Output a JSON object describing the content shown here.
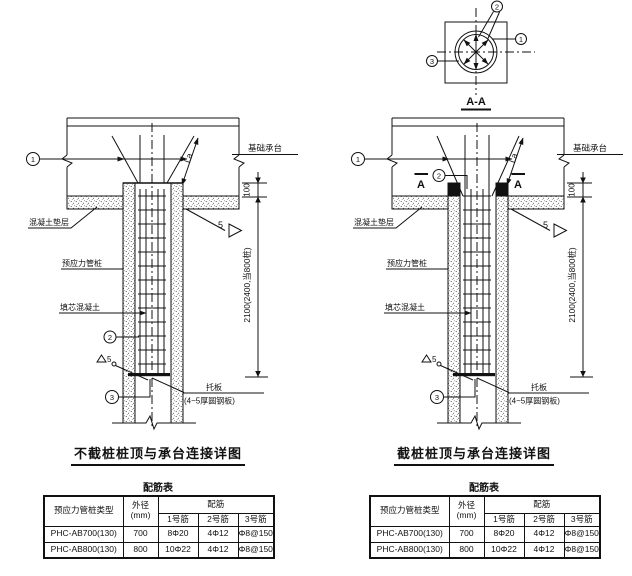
{
  "labels": {
    "foundation_cap": "基础承台",
    "concrete_cushion": "混凝土垫层",
    "prestressed_pipe_pile": "预应力管桩",
    "core_filling_concrete": "填芯混凝土",
    "bearing_plate": "托板",
    "bearing_plate_note": "(4~5厚圆钢板)",
    "anchorage_length": "La",
    "weld_size": "5",
    "embed_depth": "100",
    "pile_fill_depth": "2100(2400,当800桩)"
  },
  "callouts": {
    "n1": "1",
    "n2": "2",
    "n3": "3"
  },
  "left_figure": {
    "title": "不截桩桩顶与承台连接详图"
  },
  "right_figure": {
    "title": "截桩桩顶与承台连接详图",
    "section_title": "A-A",
    "section_mark": "A"
  },
  "rebar_table": {
    "title": "配筋表",
    "header": {
      "pile_type": "预应力管桩类型",
      "outer_diameter_line1": "外径",
      "outer_diameter_line2": "(mm)",
      "rebar_group": "配筋",
      "rebar1": "1号筋",
      "rebar2": "2号筋",
      "rebar3": "3号筋"
    },
    "rows": [
      {
        "pile_type": "PHC-AB700(130)",
        "outer_diameter": "700",
        "rebar1": "8Φ20",
        "rebar2": "4Φ12",
        "rebar3": "Φ8@150"
      },
      {
        "pile_type": "PHC-AB800(130)",
        "outer_diameter": "800",
        "rebar1": "10Φ22",
        "rebar2": "4Φ12",
        "rebar3": "Φ8@150"
      }
    ]
  }
}
